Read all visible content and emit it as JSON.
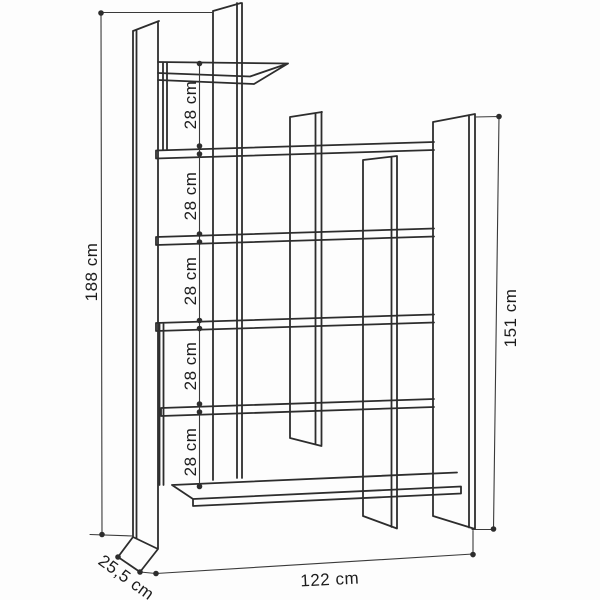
{
  "figure": {
    "kind": "furniture-technical-drawing",
    "subject": "asymmetric open bookcase shown in perspective line art with dimension annotations",
    "background_color": "#fdfdfd",
    "line_color": "#2d2d2d",
    "label_color": "#1c1c1c"
  },
  "dimension_labels": {
    "overall_height": "188 cm",
    "right_side_height": "151 cm",
    "overall_width": "122 cm",
    "depth": "25,5 cm",
    "shelf_gaps": [
      "28 cm",
      "28 cm",
      "28 cm",
      "28 cm",
      "28 cm"
    ]
  }
}
